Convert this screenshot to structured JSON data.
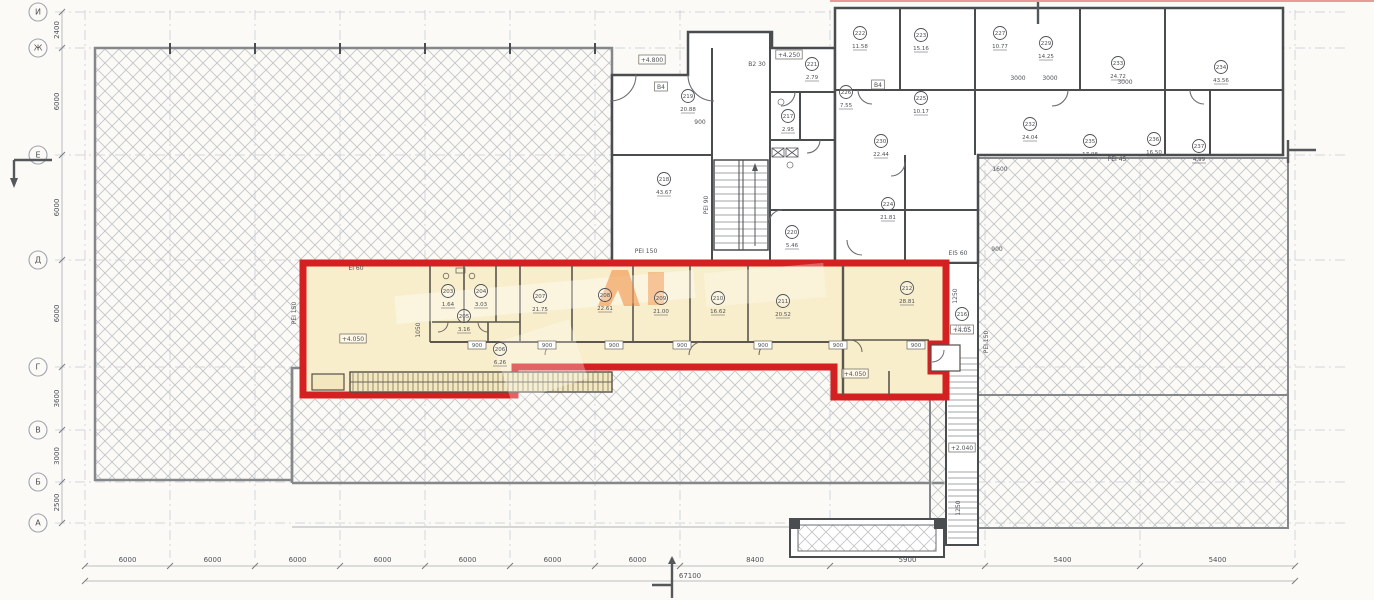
{
  "title": "floor-plan-with-highlighted-premises",
  "colors": {
    "highlight_fill": "#f8eecb",
    "highlight_border": "#d42020",
    "wall": "#4a4d50",
    "hatch": "#c3c5c8",
    "grid_line": "#c9ccd4",
    "dim_text": "#8a8d92",
    "text": "#4e5156",
    "watermark_orange": "#ef7d2a"
  },
  "grid": {
    "row_bubbles": [
      "И",
      "Ж",
      "Е",
      "Д",
      "Г",
      "В",
      "Б",
      "А"
    ],
    "left_dims": [
      "2400",
      "6000",
      "6000",
      "6000",
      "3600",
      "3000",
      "2500"
    ],
    "bottom_dims": [
      "6000",
      "6000",
      "6000",
      "6000",
      "6000",
      "6000",
      "6000",
      "8400",
      "5900",
      "5400",
      "5400"
    ],
    "bottom_total": "67100"
  },
  "highlight_zone": {
    "rooms": [
      {
        "num": "203",
        "area": "1.64",
        "x": 448,
        "y": 291
      },
      {
        "num": "204",
        "area": "3.03",
        "x": 481,
        "y": 291
      },
      {
        "num": "205",
        "area": "3.16",
        "x": 464,
        "y": 316
      },
      {
        "num": "206",
        "area": "6.26",
        "x": 500,
        "y": 349
      },
      {
        "num": "207",
        "area": "21.75",
        "x": 540,
        "y": 296
      },
      {
        "num": "208",
        "area": "22.61",
        "x": 605,
        "y": 295
      },
      {
        "num": "209",
        "area": "21.00",
        "x": 661,
        "y": 298
      },
      {
        "num": "210",
        "area": "16.62",
        "x": 718,
        "y": 298
      },
      {
        "num": "211",
        "area": "20.52",
        "x": 783,
        "y": 301
      },
      {
        "num": "212",
        "area": "28.81",
        "x": 907,
        "y": 288
      }
    ],
    "window_tags": [
      {
        "t": "900",
        "x": 477
      },
      {
        "t": "900",
        "x": 547
      },
      {
        "t": "900",
        "x": 614
      },
      {
        "t": "900",
        "x": 682
      },
      {
        "t": "900",
        "x": 763
      },
      {
        "t": "900",
        "x": 838
      },
      {
        "t": "900",
        "x": 916
      }
    ],
    "window_tag_y": 347
  },
  "stair_zone": {
    "rooms": [
      {
        "num": "216",
        "area": "20.20",
        "x": 962,
        "y": 314
      }
    ]
  },
  "upper_building": {
    "rooms": [
      {
        "num": "217",
        "area": "2.95",
        "x": 788,
        "y": 116
      },
      {
        "num": "218",
        "area": "43.67",
        "x": 664,
        "y": 179
      },
      {
        "num": "219",
        "area": "20.88",
        "x": 688,
        "y": 96
      },
      {
        "num": "220",
        "area": "5.46",
        "x": 792,
        "y": 232
      },
      {
        "num": "221",
        "area": "2.79",
        "x": 812,
        "y": 64
      }
    ]
  },
  "right_building": {
    "rooms": [
      {
        "num": "222",
        "area": "11.58",
        "x": 860,
        "y": 33
      },
      {
        "num": "223",
        "area": "15.16",
        "x": 921,
        "y": 35
      },
      {
        "num": "224",
        "area": "21.81",
        "x": 888,
        "y": 204
      },
      {
        "num": "225",
        "area": "10.17",
        "x": 921,
        "y": 98
      },
      {
        "num": "226",
        "area": "7.55",
        "x": 846,
        "y": 92
      },
      {
        "num": "227",
        "area": "10.77",
        "x": 1000,
        "y": 33
      },
      {
        "num": "229",
        "area": "14.25",
        "x": 1046,
        "y": 43
      },
      {
        "num": "230",
        "area": "22.44",
        "x": 881,
        "y": 141
      },
      {
        "num": "232",
        "area": "24.04",
        "x": 1030,
        "y": 124
      },
      {
        "num": "233",
        "area": "24.72",
        "x": 1118,
        "y": 63
      },
      {
        "num": "234",
        "area": "43.56",
        "x": 1221,
        "y": 67
      },
      {
        "num": "235",
        "area": "17.08",
        "x": 1090,
        "y": 141
      },
      {
        "num": "236",
        "area": "16.50",
        "x": 1154,
        "y": 139
      },
      {
        "num": "237",
        "area": "4.99",
        "x": 1199,
        "y": 146
      }
    ]
  },
  "labels": [
    {
      "t": "+4.800",
      "x": 652,
      "y": 62,
      "boxed": true
    },
    {
      "t": "+4.250",
      "x": 789,
      "y": 57,
      "boxed": true
    },
    {
      "t": "В2 30",
      "x": 757,
      "y": 66
    },
    {
      "t": "В4",
      "x": 661,
      "y": 89,
      "boxed": true
    },
    {
      "t": "В4",
      "x": 878,
      "y": 87,
      "boxed": true
    },
    {
      "t": "РЕІ 90",
      "x": 708,
      "y": 205,
      "rot": -90
    },
    {
      "t": "РЕІ 150",
      "x": 646,
      "y": 253
    },
    {
      "t": "РЕІ 150",
      "x": 296,
      "y": 313,
      "rot": -90
    },
    {
      "t": "РЕІ 150",
      "x": 988,
      "y": 342,
      "rot": -90
    },
    {
      "t": "РЕІ 45",
      "x": 1117,
      "y": 161
    },
    {
      "t": "ЕІ 60",
      "x": 356,
      "y": 270
    },
    {
      "t": "ЕІ5 60",
      "x": 958,
      "y": 255
    },
    {
      "t": "+4.050",
      "x": 353,
      "y": 341,
      "boxed": true
    },
    {
      "t": "+4.050",
      "x": 855,
      "y": 376,
      "boxed": true
    },
    {
      "t": "+4.05",
      "x": 962,
      "y": 332,
      "boxed": true
    },
    {
      "t": "+2.040",
      "x": 962,
      "y": 450,
      "boxed": true
    },
    {
      "t": "1250",
      "x": 957,
      "y": 296,
      "rot": -90
    },
    {
      "t": "1250",
      "x": 960,
      "y": 508,
      "rot": -90
    },
    {
      "t": "900",
      "x": 700,
      "y": 124
    },
    {
      "t": "900",
      "x": 997,
      "y": 251
    },
    {
      "t": "1600",
      "x": 1000,
      "y": 171
    },
    {
      "t": "3000",
      "x": 1018,
      "y": 80
    },
    {
      "t": "3000",
      "x": 1050,
      "y": 80
    },
    {
      "t": "3000",
      "x": 1125,
      "y": 84
    },
    {
      "t": "1050",
      "x": 420,
      "y": 330,
      "rot": -90
    }
  ]
}
